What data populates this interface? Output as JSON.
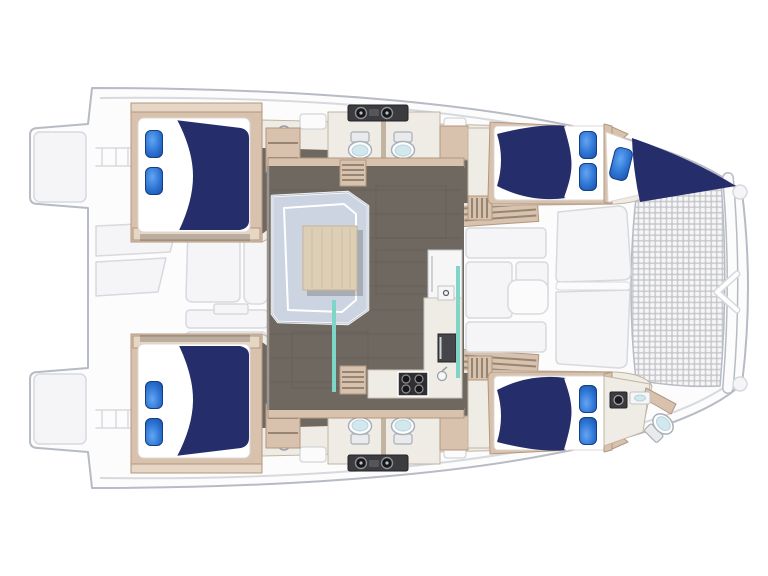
{
  "meta": {
    "description": "Top-down accommodation floor plan of a 4-cabin sailing catamaran, bow to the right, trampoline at bow, salon and galley on the bridgedeck, double berths in each hull"
  },
  "colors": {
    "hull-fill": "#fcfcfd",
    "hull-stroke": "#b7bbc3",
    "ghost-fill": "#f5f5f7",
    "ghost-stroke": "#d6d9de",
    "mesh-line": "#c8c9cd",
    "mesh-cell": "#f6f6f7",
    "floor": "#6f6860",
    "floor-line": "#5d574f",
    "wood": "#d8c2ae",
    "wood-light": "#e6d6c6",
    "wood-dark": "#b2977f",
    "cream": "#efece6",
    "cream-stroke": "#c2b4a1",
    "mattress-stroke": "#ddd8d0",
    "navy": "#252e6b",
    "pillow-hi": "#62a6f2",
    "pillow-mid": "#2e74d4",
    "pillow-lo": "#1a4fa4",
    "pillow-edge": "#123e85",
    "sofa": "#ccd3e1",
    "sofa-edge": "#a9b2c4",
    "table": "#ddcfb6",
    "table-stroke": "#c7b394",
    "teal": "#7fd6c8",
    "dark-panel": "#3c3c40",
    "stove": "#2f2f33",
    "appliance": "#45454a",
    "toilet-stroke": "#a9b0b8",
    "toilet-lid": "#d3e7ee",
    "stripe": "#8a7a68"
  },
  "regions": {
    "trampoline": "bow trampoline net",
    "foredeck": "foredeck lounge",
    "salon": "salon with U-sofa and table",
    "galley": "galley with stove, sink and fridge",
    "aft_port_cabin": "aft port double cabin",
    "aft_starboard_cabin": "aft starboard double cabin",
    "fwd_port_cabin": "forward port double cabin",
    "fwd_starboard_cabin": "forward starboard double cabin",
    "forepeak_berth": "port forepeak berth",
    "bow_head": "starboard bow head",
    "heads": "en-suite heads with toilets and vanities",
    "stern": "aft cockpit and swim platforms"
  }
}
